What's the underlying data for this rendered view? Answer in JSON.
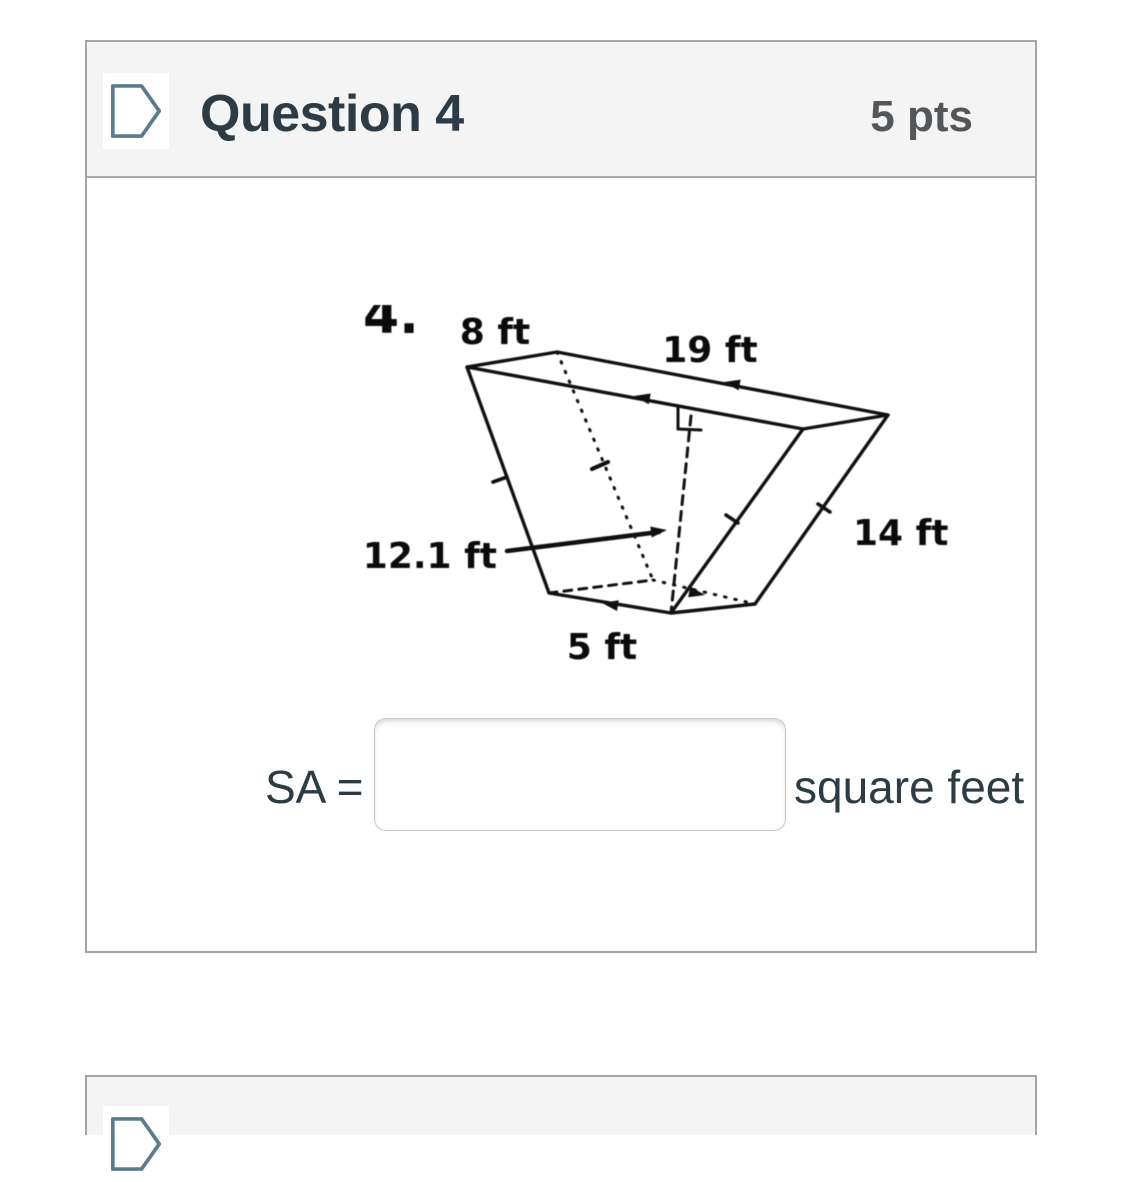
{
  "header": {
    "title": "Question 4",
    "points": "5 pts"
  },
  "figure": {
    "question_number": "4.",
    "dimension_labels": {
      "top_width": "8 ft",
      "prism_length": "19 ft",
      "trapezoid_height": "12.1 ft",
      "lateral_edge": "14 ft",
      "bottom_width": "5 ft"
    }
  },
  "answer_row": {
    "label": "SA =",
    "input_value": "",
    "input_placeholder": "",
    "unit": "square feet"
  },
  "colors": {
    "header_bg": "#f4f4f4",
    "card_border": "#a5a5a5",
    "title_text": "#2d3b45",
    "points_text": "#545759",
    "icon_outline": "#5d7b8e",
    "figure_ink": "#151515",
    "input_border": "#c8c8c8"
  }
}
